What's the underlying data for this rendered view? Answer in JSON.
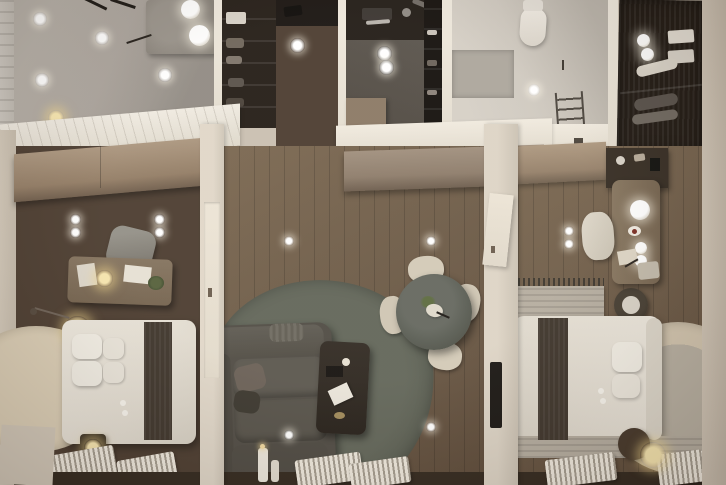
{
  "meta": {
    "title": "Top-down 3D architectural render of a furnished apartment",
    "type": "photoreal-floorplan-render",
    "view": "overhead"
  },
  "palette": {
    "wallCream": "#c9bfb1",
    "wallWhite": "#eae4da",
    "marbleGray": "#a9a29a",
    "marbleWhite": "#e8e3da",
    "woodDark": "#4c3d31",
    "woodMid": "#6c5a49",
    "kitchenFloor": "#57514a",
    "cabinetDark": "#221c17",
    "closetDark": "#241d17",
    "cabinetTan": "#a28c75",
    "sideboardTaupe": "#948474",
    "sofaGray": "#55514a",
    "rugGreen": "#5c6053",
    "rugBeige": "#d5c8b0",
    "bedWhite": "#e7e2d8",
    "runnerDark": "#3e352c",
    "tableMarble": "#53564d",
    "chairCream": "#d3cab8",
    "radiatorWhite": "#efe9de",
    "deskTaupe": "#7c6b59",
    "sillDark": "#33291f",
    "glowWhite": "#ffffff",
    "glowWarm": "#f3e0a8"
  },
  "scene": {
    "rooms": [
      {
        "name": "entry-lounge-top-left",
        "floor": "gray-marble"
      },
      {
        "name": "hallway",
        "floor": "dark-wood"
      },
      {
        "name": "kitchen",
        "floor": "dark-tile"
      },
      {
        "name": "bathroom",
        "floor": "light-stone"
      },
      {
        "name": "walk-in-closet",
        "floor": "dark-wood"
      },
      {
        "name": "bedroom-left",
        "floor": "dark-wood"
      },
      {
        "name": "living-room",
        "floor": "mid-wood"
      },
      {
        "name": "bedroom-right",
        "floor": "mid-wood"
      }
    ],
    "furniture": [
      "stone-counter",
      "pendant-sphere-lights",
      "ceiling-spotlights",
      "tan-wardrobe-cabinets",
      "taupe-sideboard",
      "desk-left",
      "desk-right",
      "office-chair",
      "cream-chair",
      "double-bed-left",
      "double-bed-right",
      "pillows",
      "dark-bed-runner",
      "bedside-table",
      "ball-lamp",
      "arc-floor-lamp",
      "round-beige-rug-left",
      "round-beige-rug-right",
      "green-gray-living-rug",
      "sectional-sofa",
      "coffee-table",
      "round-dining-table",
      "dining-chairs",
      "toilet",
      "towel-ladder",
      "window-radiators",
      "wall-tv",
      "side-stool",
      "knit-mat",
      "candlesticks"
    ]
  }
}
